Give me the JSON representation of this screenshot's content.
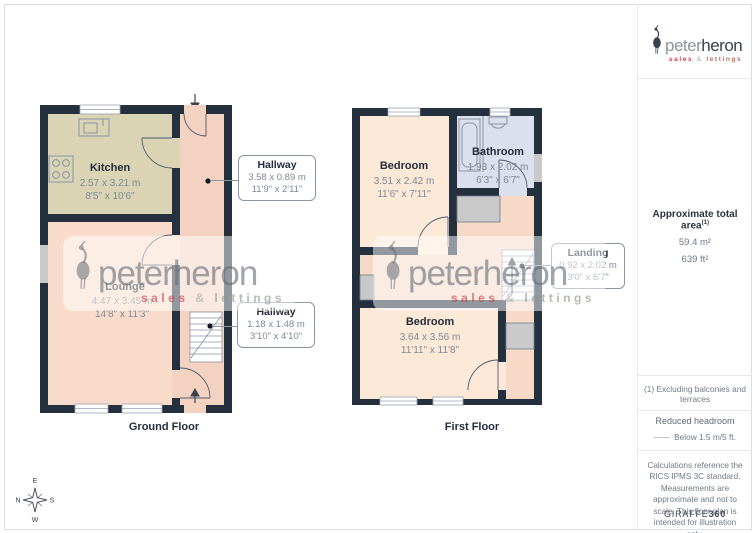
{
  "brand": {
    "name_first": "peter",
    "name_second": "heron",
    "tagline": {
      "sales": "sales",
      "amp": "&",
      "lettings": "lettings"
    },
    "colors": {
      "accent_red": "#d63c49",
      "dark": "#39424e"
    }
  },
  "plans": {
    "ground": {
      "label": "Ground Floor",
      "kitchen": {
        "name": "Kitchen",
        "dims_m": "2.57 x 3.21 m",
        "dims_ft": "8'5\" x 10'6\""
      },
      "lounge": {
        "name": "Lounge",
        "dims_m": "4.47 x 3.45 m",
        "dims_ft": "14'8\" x 11'3\""
      },
      "hallway_upper": {
        "name": "Hallway",
        "dims_m": "3.58 x 0.89 m",
        "dims_ft": "11'9\" x 2'11\""
      },
      "hallway_lower": {
        "name": "Hallway",
        "dims_m": "1.18 x 1.48 m",
        "dims_ft": "3'10\" x 4'10\""
      }
    },
    "first": {
      "label": "First Floor",
      "bedroom_front": {
        "name": "Bedroom",
        "dims_m": "3.51 x 2.42 m",
        "dims_ft": "11'6\" x 7'11\""
      },
      "bathroom": {
        "name": "Bathroom",
        "dims_m": "1.93 x 2.02 m",
        "dims_ft": "6'3\" x 6'7\""
      },
      "landing": {
        "name": "Landing",
        "dims_m": "0.92 x 2.02 m",
        "dims_ft": "3'0\" x 6'7\""
      },
      "bedroom_back": {
        "name": "Bedroom",
        "dims_m": "3.64 x 3.56 m",
        "dims_ft": "11'11\" x 11'8\""
      }
    }
  },
  "sidebar": {
    "area_title": "Approximate total area",
    "area_footnote_ref": "(1)",
    "area_metric": "59.4 m²",
    "area_imperial": "639 ft²",
    "footnote": "(1) Excluding balconies and terraces",
    "headroom_title": "Reduced headroom",
    "headroom_value": "Below 1.5 m/5 ft.",
    "disclaimer": "Calculations reference the RICS IPMS 3C standard. Measurements are approximate and not to scale. This floor plan is intended for illustration only.",
    "provider_name": "GIRAFFE",
    "provider_suffix": "360"
  },
  "compass": {
    "top": "E",
    "left": "N",
    "right": "S",
    "bottom": "W"
  },
  "palette": {
    "wall": "#25303f",
    "kitchen_floor": "#dad4b5",
    "lounge_floor": "#f8dbca",
    "hallway_floor": "#f3d2c2",
    "bedroom_floor": "#fce9d7",
    "landing_floor": "#f6d9c7",
    "bathroom_floor": "#dbe0ed",
    "cupboard_gray": "#c9c9c9"
  }
}
